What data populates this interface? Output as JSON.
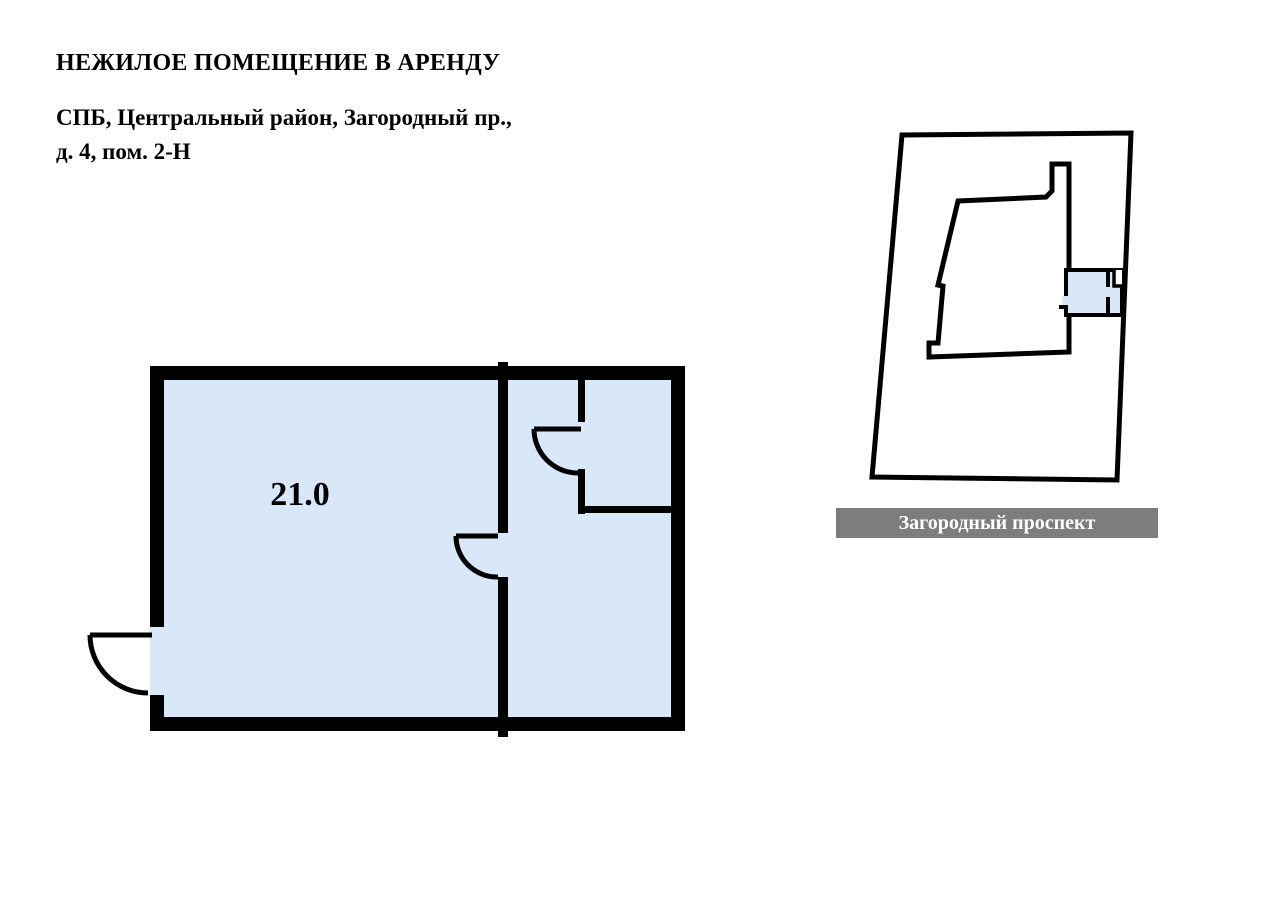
{
  "header": {
    "title": "НЕЖИЛОЕ ПОМЕЩЕНИЕ В АРЕНДУ",
    "address_line1": "СПБ, Центральный район, Загородный пр.,",
    "address_line2": "д. 4, пом. 2-Н"
  },
  "floor_plan": {
    "area_sqm": "21.0"
  },
  "site_plan": {
    "street_name": "Загородный проспект"
  },
  "colors": {
    "premises_fill": "#d9e8f8",
    "wall": "#000000",
    "building_fill": "#ffffff",
    "street_bar_bg": "#7d7d7d",
    "street_bar_text": "#ffffff"
  }
}
